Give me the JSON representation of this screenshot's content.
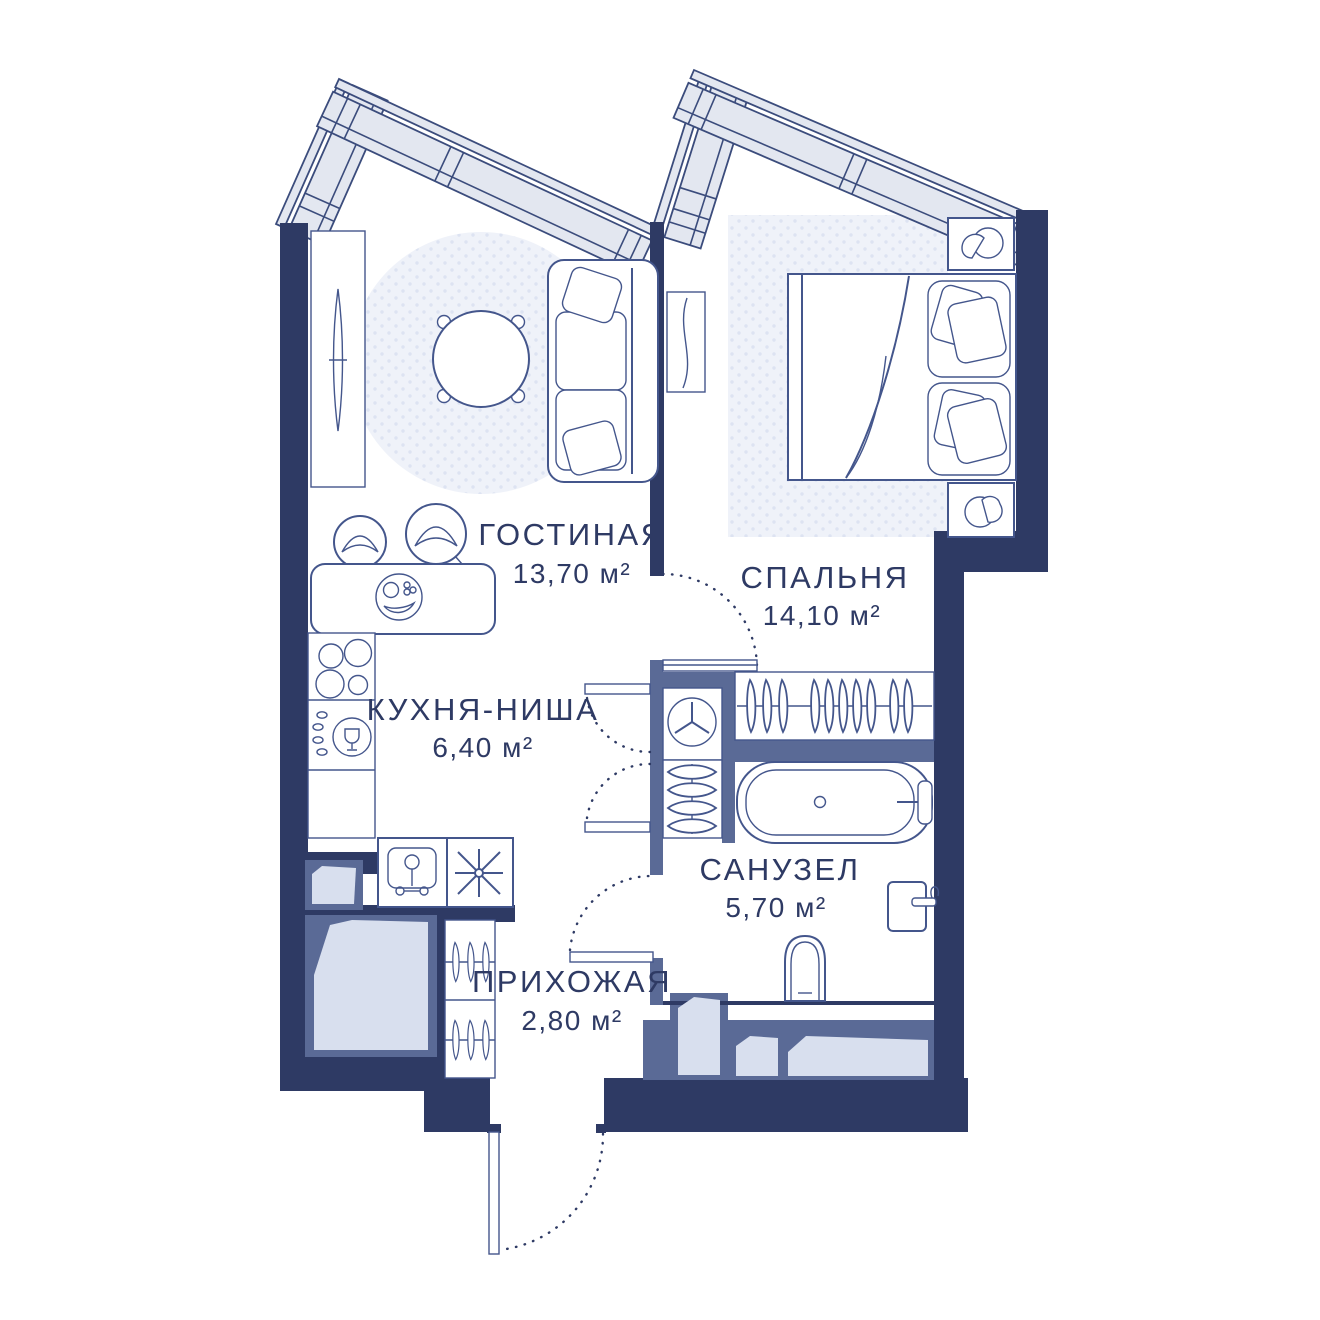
{
  "plan": {
    "type": "apartment-floor-plan",
    "rooms": [
      {
        "id": "living",
        "name": "ГОСТИНАЯ",
        "area": "13,70 м²"
      },
      {
        "id": "bedroom",
        "name": "СПАЛЬНЯ",
        "area": "14,10 м²"
      },
      {
        "id": "kitchen",
        "name": "КУХНЯ-НИША",
        "area": "6,40 м²"
      },
      {
        "id": "bathroom",
        "name": "САНУЗЕЛ",
        "area": "5,70 м²"
      },
      {
        "id": "hallway",
        "name": "ПРИХОЖАЯ",
        "area": "2,80 м²"
      }
    ],
    "colors": {
      "wall": "#2e3a64",
      "partition": "#5a6a96",
      "window_fill": "#e3e7f0",
      "shaft_fill": "#d8dfee",
      "furniture_line": "#44568c",
      "rug_fill": "#eff2f9",
      "rug_dot": "#dde3f2",
      "text": "#2e3a64",
      "background": "#ffffff"
    },
    "icons": [
      "tv-console-icon",
      "round-rug-icon",
      "round-table-icon",
      "sofa-icon",
      "curtain-panel-icon",
      "bar-counter-icon",
      "bar-stool-icon",
      "fruit-plate-icon",
      "cooktop-burners-icon",
      "kitchen-sink-icon",
      "basin-icon",
      "star-burst-icon",
      "bed-icon",
      "pillow-icon",
      "nightstand-lamp-icon",
      "wardrobe-hangers-icon",
      "washing-machine-icon",
      "folded-linen-icon",
      "bathtub-icon",
      "toilet-icon",
      "washbasin-icon",
      "vent-shaft-icon",
      "door-swing-icon",
      "window-band-icon",
      "entry-door-icon"
    ]
  }
}
